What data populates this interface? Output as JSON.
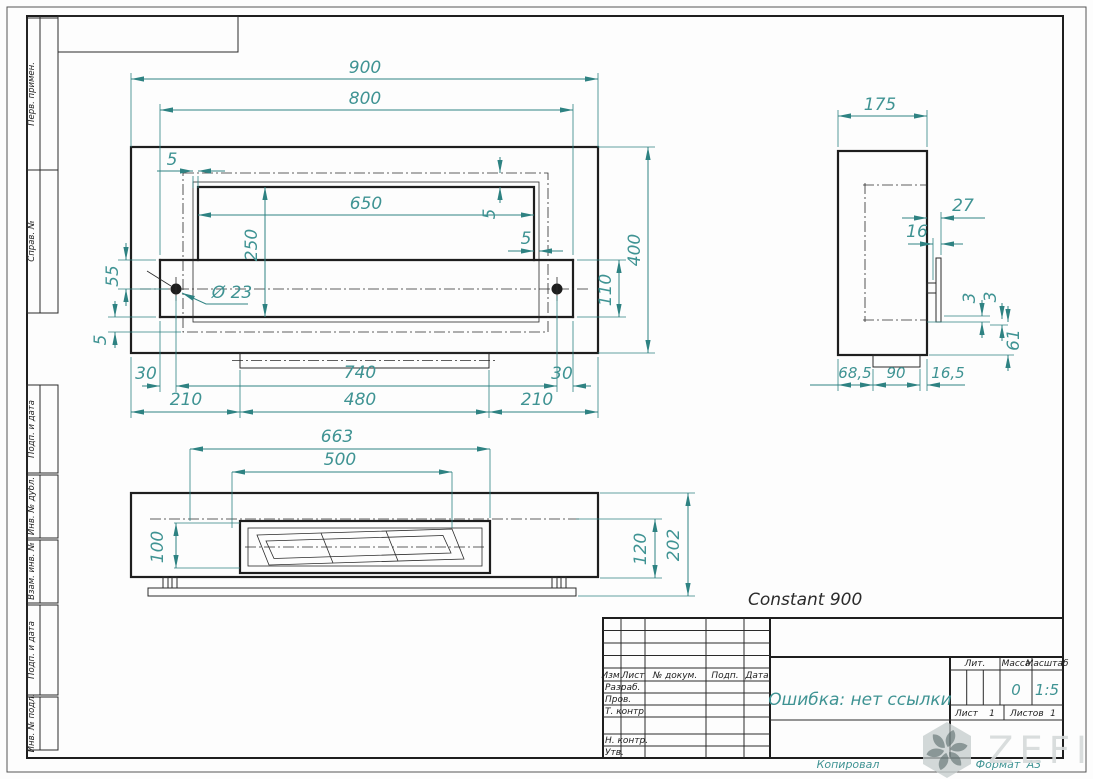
{
  "product": {
    "name": "Constant 900"
  },
  "colors": {
    "dimension_teal": "#2e8282",
    "dim_text_teal": "#3f9393",
    "line_black": "#1e1e1e",
    "watermark_gray": "#d6dada"
  },
  "dims": {
    "front": {
      "w900": "900",
      "w800": "800",
      "w650": "650",
      "h250": "250",
      "h400": "400",
      "h110": "110",
      "v55": "55",
      "v5": "5",
      "hole": "Ø 23",
      "b30": "30",
      "b740": "740",
      "b210": "210",
      "b480": "480"
    },
    "bottom": {
      "w663": "663",
      "w500": "500",
      "h100": "100",
      "h120": "120",
      "h202": "202"
    },
    "side": {
      "w175": "175",
      "o27": "27",
      "o16": "16",
      "t3": "3",
      "h61": "61",
      "b68": "68,5",
      "b90": "90",
      "b16": "16,5"
    }
  },
  "margin": {
    "labels": [
      "Перв. примен.",
      "Справ. №",
      "Подп. и дата",
      "Инв. № дубл.",
      "Взам. инв. №",
      "Подп. и дата",
      "Инв. № подл."
    ]
  },
  "tb": {
    "header": [
      "Изм.",
      "Лист",
      "№ докум.",
      "Подп.",
      "Дата"
    ],
    "rows": [
      "Разраб.",
      "Пров.",
      "Т. контр.",
      "Н. контр.",
      "Утв."
    ],
    "doc_name": "Ошибка: нет ссылки",
    "lit_label": "Лит.",
    "mass_label": "Масса",
    "scale_label": "Масштаб",
    "mass_value": "0",
    "scale_value": "1:5",
    "sheet_label": "Лист",
    "sheet_value": "1",
    "sheets_label": "Листов",
    "sheets_value": "1",
    "kopiroval": "Копировал",
    "format_label": "Формат",
    "format_value": "A3"
  },
  "watermark": {
    "text": "ZEFIRE"
  }
}
